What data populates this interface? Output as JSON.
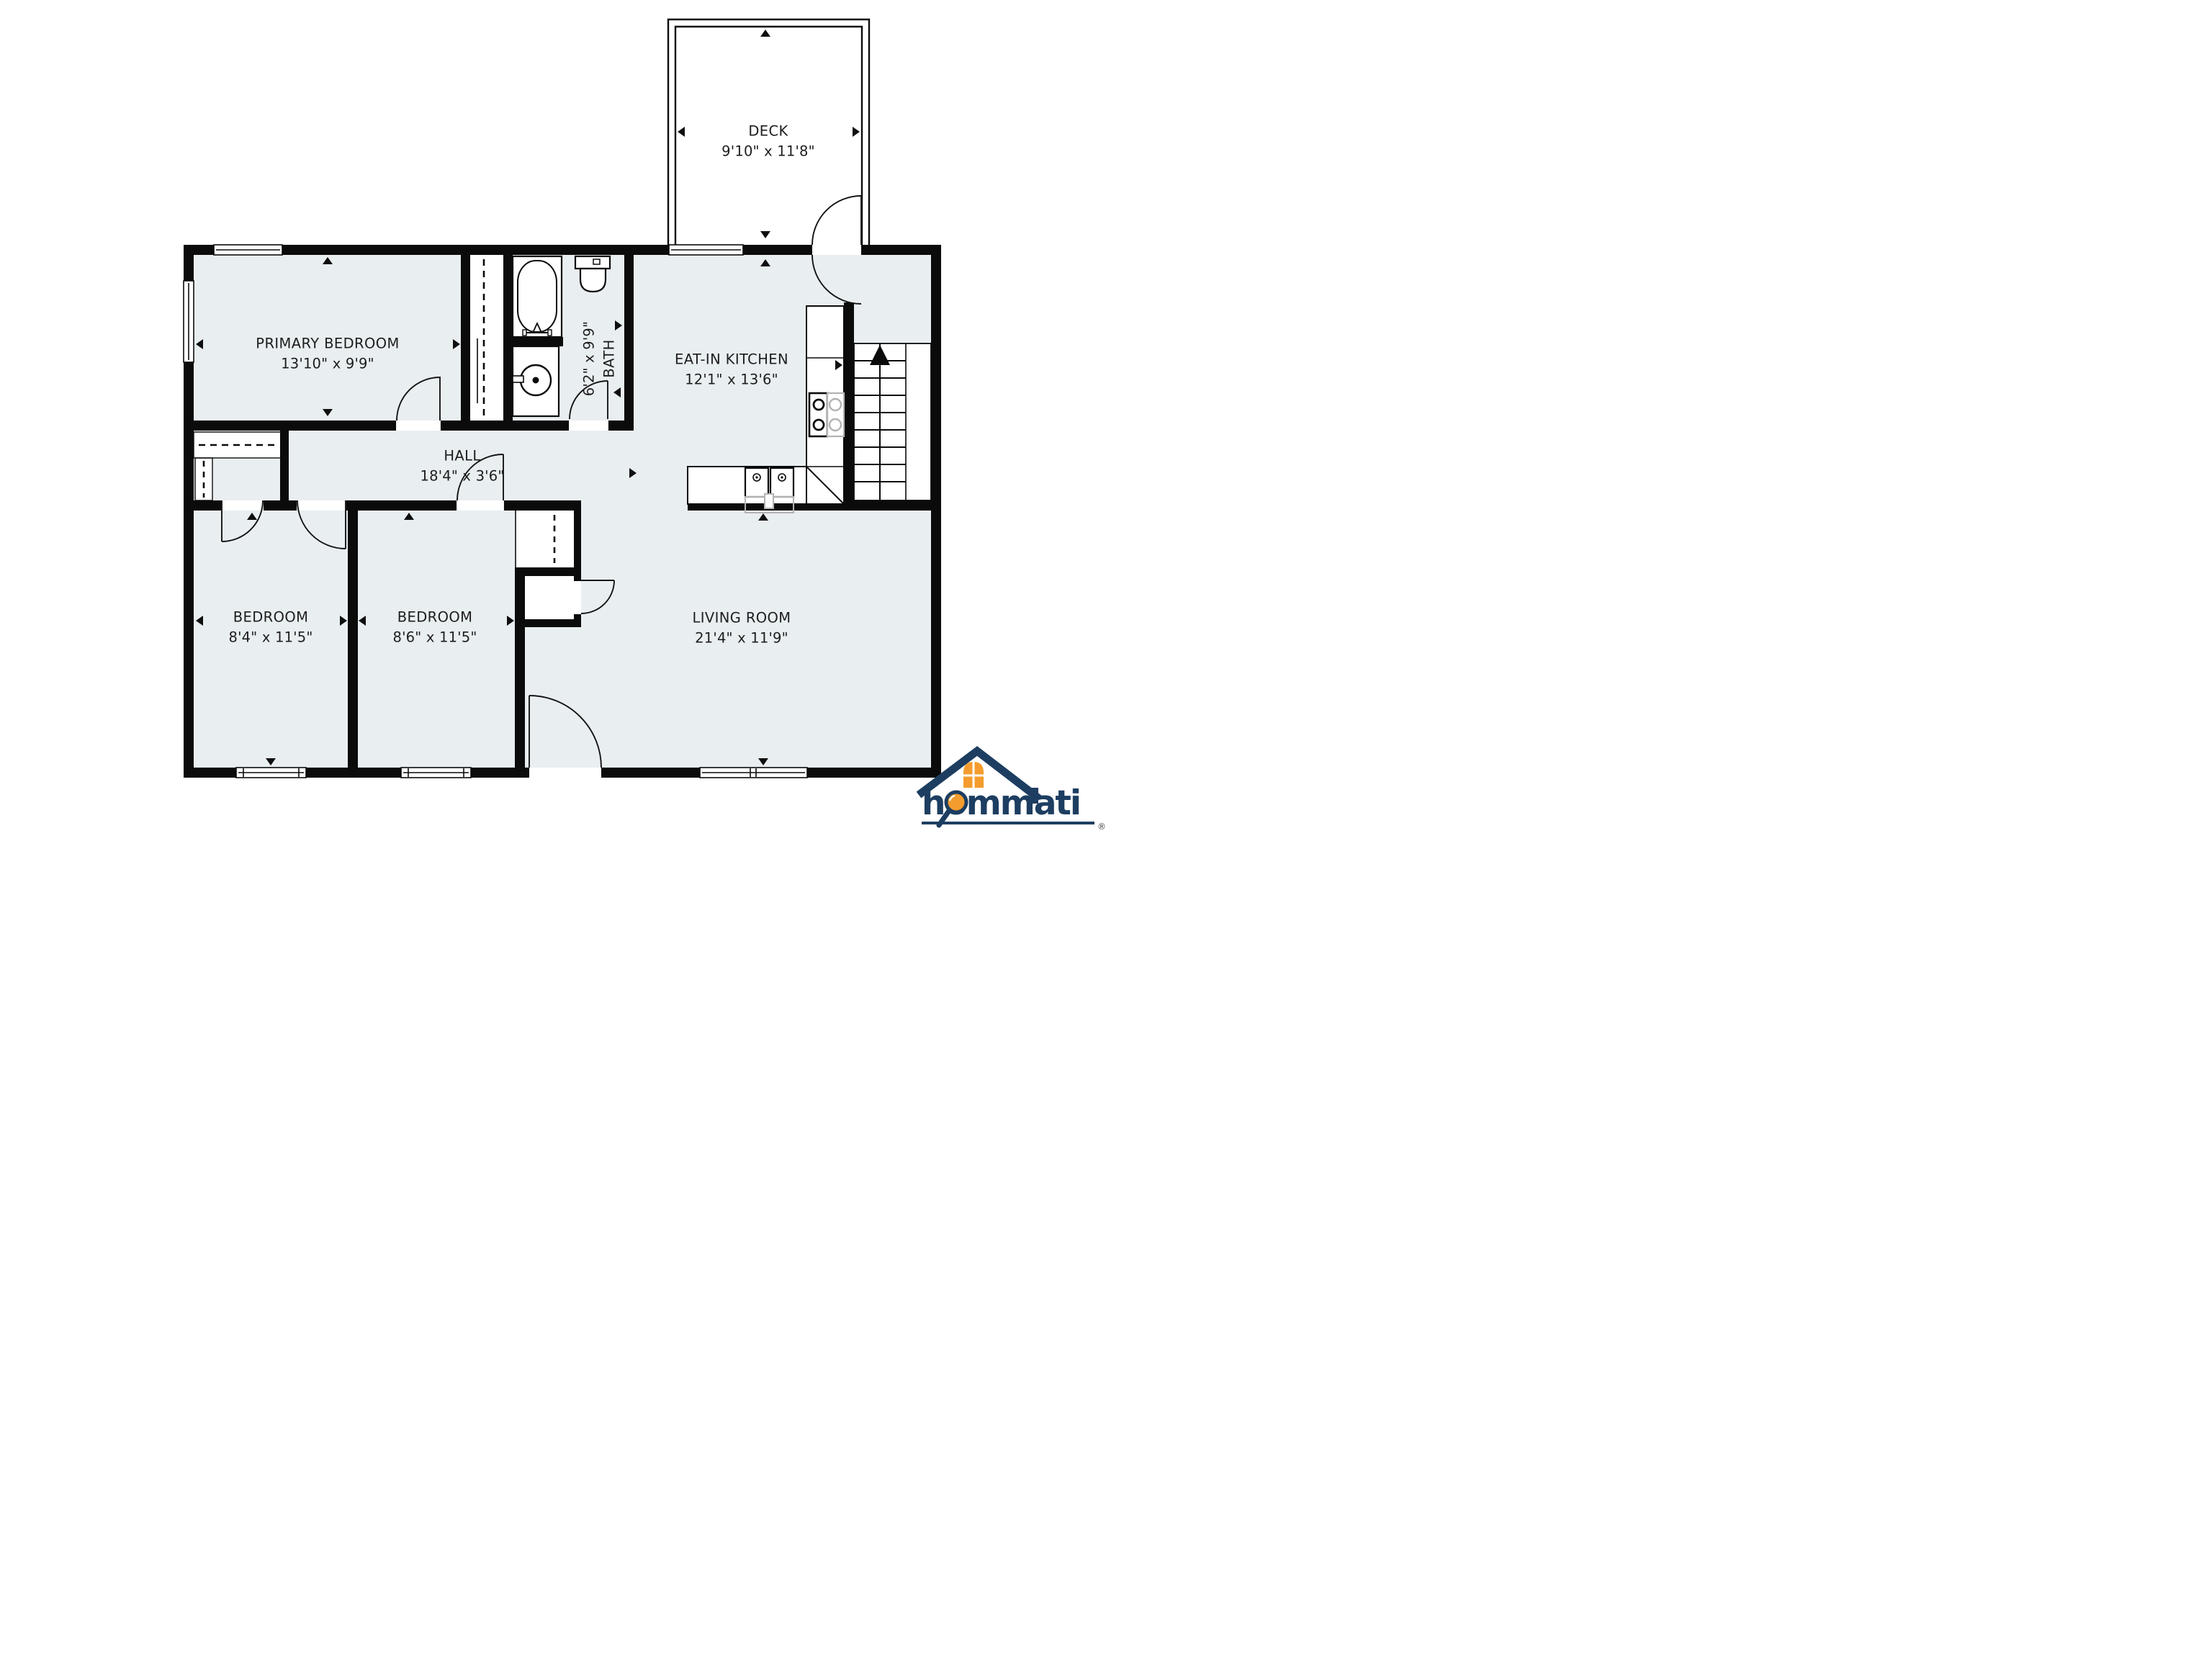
{
  "plan_title": "floor-plan",
  "colors": {
    "wall": "#0b0b0b",
    "room_fill": "#e9eef1",
    "fixture_grey": "#b3b3b3",
    "logo_navy": "#1d3e61",
    "logo_orange": "#f49c2d"
  },
  "rooms": [
    {
      "id": "deck",
      "name": "DECK",
      "dims": "9'10\" x 11'8\""
    },
    {
      "id": "primary-bedroom",
      "name": "PRIMARY BEDROOM",
      "dims": "13'10\" x 9'9\""
    },
    {
      "id": "bath",
      "name": "BATH",
      "dims": "6'2\" x 9'9\""
    },
    {
      "id": "eat-in-kitchen",
      "name": "EAT-IN KITCHEN",
      "dims": "12'1\" x 13'6\""
    },
    {
      "id": "hall",
      "name": "HALL",
      "dims": "18'4\" x 3'6\""
    },
    {
      "id": "bedroom-left",
      "name": "BEDROOM",
      "dims": "8'4\" x 11'5\""
    },
    {
      "id": "bedroom-middle",
      "name": "BEDROOM",
      "dims": "8'6\" x 11'5\""
    },
    {
      "id": "living-room",
      "name": "LIVING ROOM",
      "dims": "21'4\" x 11'9\""
    }
  ],
  "logo": {
    "brand": "hommati",
    "registered": "®"
  }
}
